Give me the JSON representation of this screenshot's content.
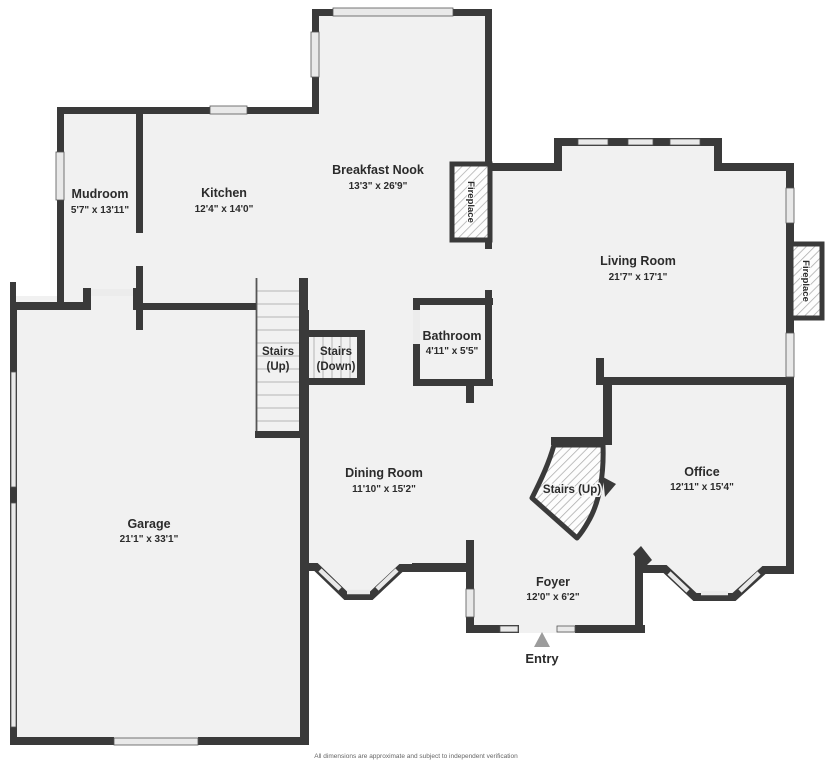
{
  "rooms": {
    "mudroom": {
      "name": "Mudroom",
      "dims": "5'7\" x 13'11\""
    },
    "kitchen": {
      "name": "Kitchen",
      "dims": "12'4\" x 14'0\""
    },
    "breakfast_nook": {
      "name": "Breakfast Nook",
      "dims": "13'3\" x 26'9\""
    },
    "living_room": {
      "name": "Living Room",
      "dims": "21'7\" x 17'1\""
    },
    "bathroom": {
      "name": "Bathroom",
      "dims": "4'11\" x 5'5\""
    },
    "dining_room": {
      "name": "Dining Room",
      "dims": "11'10\" x 15'2\""
    },
    "garage": {
      "name": "Garage",
      "dims": "21'1\" x 33'1\""
    },
    "office": {
      "name": "Office",
      "dims": "12'11\" x 15'4\""
    },
    "foyer": {
      "name": "Foyer",
      "dims": "12'0\" x 6'2\""
    }
  },
  "stairs": {
    "up_main_line1": "Stairs",
    "up_main_line2": "(Up)",
    "down_line1": "Stairs",
    "down_line2": "(Down)",
    "up_curved": "Stairs (Up)"
  },
  "labels": {
    "fireplace": "Fireplace",
    "entry": "Entry"
  },
  "footer": {
    "disclaimer": "All dimensions are approximate and subject to independent verification"
  },
  "colors": {
    "wall": "#3a3a3a",
    "floor": "#f1f1f1",
    "window": "#e9e9e9",
    "hatch": "#ababab",
    "entry_arrow": "#9c9c9c",
    "text": "#2b2b2b"
  }
}
